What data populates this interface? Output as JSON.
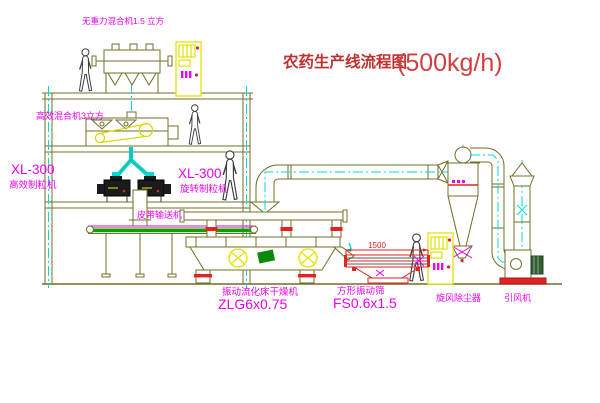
{
  "title": {
    "text": "农药生产线流程图",
    "capacity": "(500kg/h)"
  },
  "labels": {
    "gravity_mixer": "无重力混合机1.5 立方",
    "high_eff_mixer": "高效混合机3立方",
    "granulator_left_model": "XL-300",
    "granulator_left_name": "高效制粒机",
    "granulator_right_model": "XL-300",
    "granulator_right_name": "旋转制粒机",
    "belt_conveyor": "皮带输送机",
    "dryer_name": "振动流化床干燥机",
    "dryer_model": "ZLG6x0.75",
    "sieve_name": "方形振动筛",
    "sieve_model": "FS0.6x1.5",
    "sieve_dimension": "1500",
    "cyclone_name": "旋风除尘器",
    "fan_name": "引风机"
  },
  "colors": {
    "structure_olive": "#6f6f28",
    "label_magenta": "#ee00ee",
    "title_red": "#c23030",
    "centerline_cyan": "#00d8d8",
    "cabinet_yellow": "#e3e300",
    "conveyor_green": "#00a300",
    "alert_red": "#e32222"
  }
}
